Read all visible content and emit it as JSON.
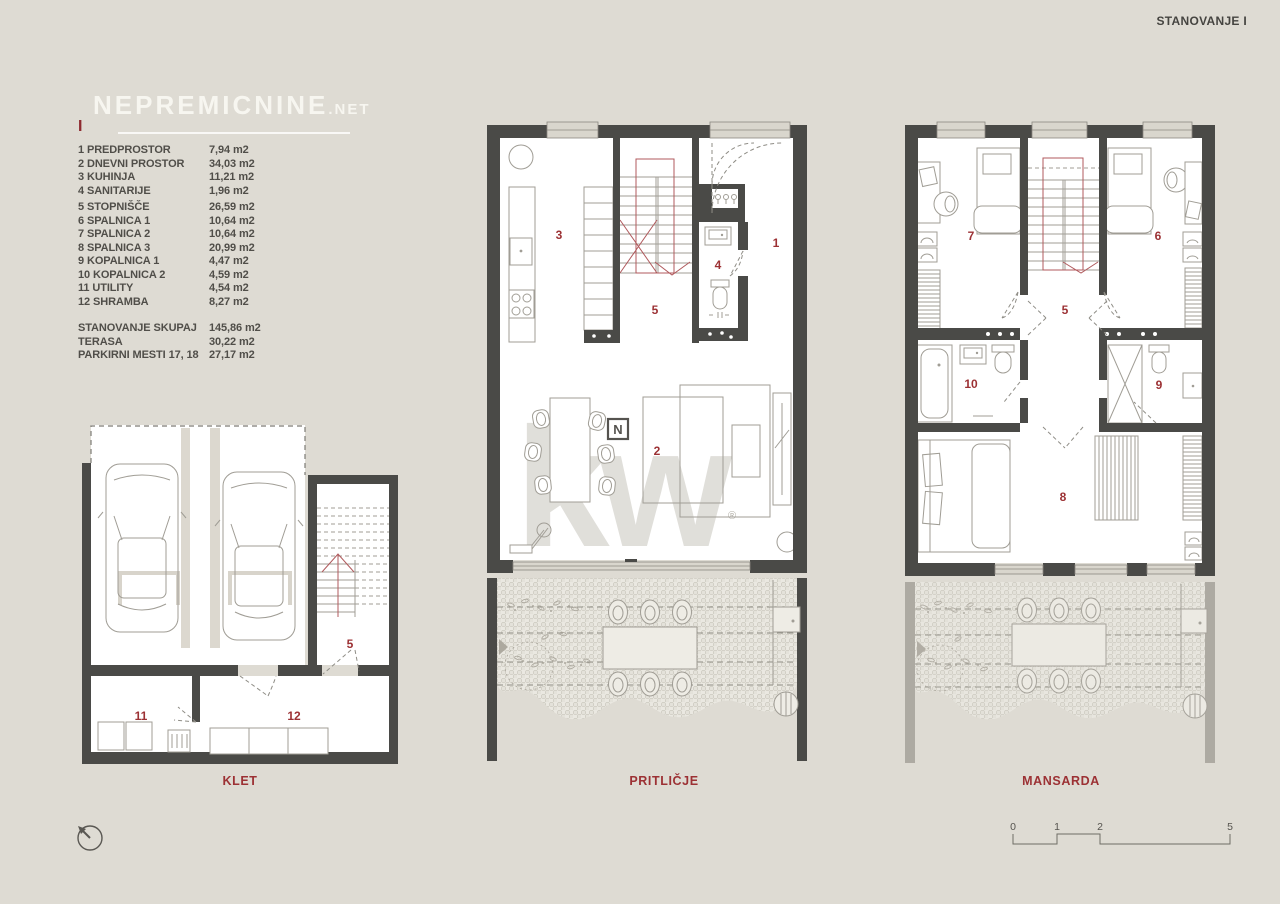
{
  "page": {
    "title": "STANOVANJE I"
  },
  "colors": {
    "background": "#dedbd3",
    "wall": "#4a4a47",
    "accent_red": "#9c3134"
  },
  "logo": {
    "text": "NEPREMICNINE",
    "tld": ".NET"
  },
  "legend": {
    "marker": "I",
    "items": [
      {
        "label": "1 PREDPROSTOR",
        "value": "7,94 m2"
      },
      {
        "label": "2 DNEVNI PROSTOR",
        "value": "34,03 m2"
      },
      {
        "label": "3 KUHINJA",
        "value": "11,21 m2"
      },
      {
        "label": "4 SANITARIJE",
        "value": "1,96 m2"
      },
      {
        "label": "5 STOPNIŠČE",
        "value": "26,59 m2"
      },
      {
        "label": "6 SPALNICA 1",
        "value": "10,64 m2"
      },
      {
        "label": "7 SPALNICA 2",
        "value": "10,64 m2"
      },
      {
        "label": "8 SPALNICA 3",
        "value": "20,99 m2"
      },
      {
        "label": "9 KOPALNICA 1",
        "value": "4,47 m2"
      },
      {
        "label": "10 KOPALNICA 2",
        "value": "4,59 m2"
      },
      {
        "label": "11 UTILITY",
        "value": "4,54 m2"
      },
      {
        "label": "12 SHRAMBA",
        "value": "8,27 m2"
      }
    ],
    "totals": [
      {
        "label": "STANOVANJE  SKUPAJ",
        "value": "145,86 m2"
      },
      {
        "label": "TERASA",
        "value": "30,22 m2"
      },
      {
        "label": "PARKIRNI MESTI 17, 18",
        "value": "27,17 m2"
      }
    ]
  },
  "floors": {
    "klet": {
      "label": "KLET",
      "rooms": {
        "r5": "5",
        "r11": "11",
        "r12": "12"
      }
    },
    "pritlicje": {
      "label": "PRITLIČJE",
      "rooms": {
        "r1": "1",
        "r2": "2",
        "r3": "3",
        "r4": "4",
        "r5": "5"
      }
    },
    "mansarda": {
      "label": "MANSARDA",
      "rooms": {
        "r5": "5",
        "r6": "6",
        "r7": "7",
        "r8": "8",
        "r9": "9",
        "r10": "10"
      }
    }
  },
  "watermark": {
    "kw": "kw",
    "registered": "®",
    "n_badge": "N"
  },
  "scalebar": {
    "ticks": [
      "0",
      "1",
      "2",
      "5"
    ]
  }
}
